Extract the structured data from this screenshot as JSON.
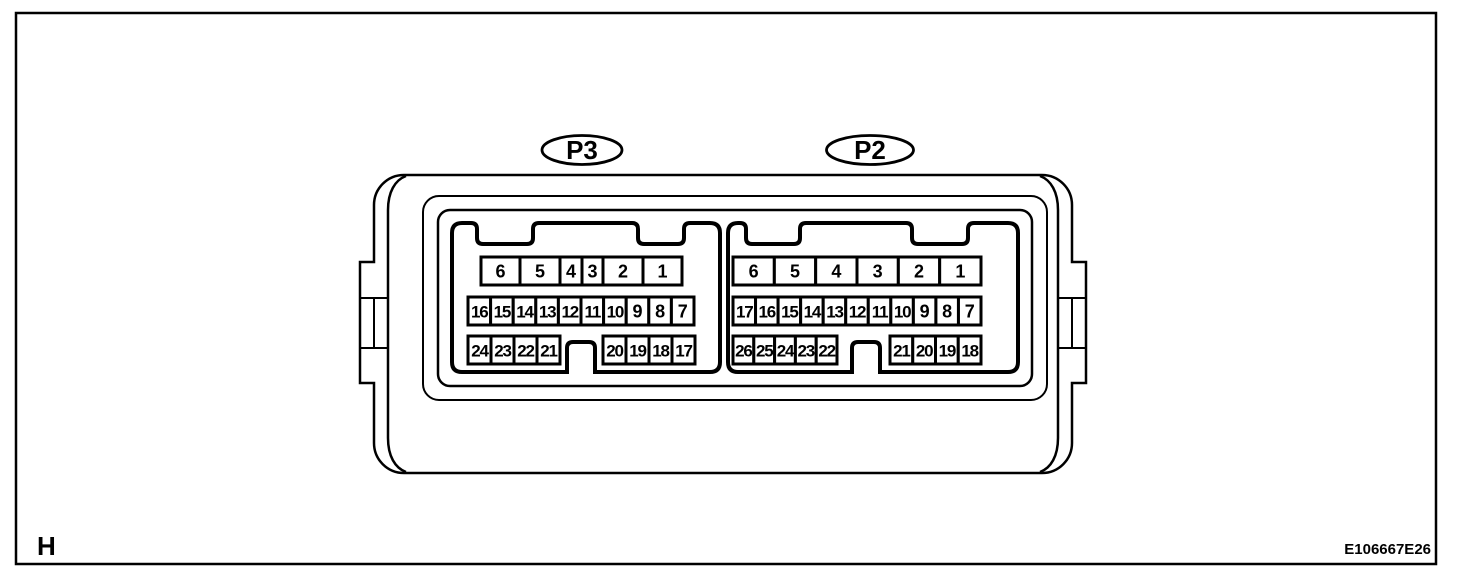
{
  "figure": {
    "page_marker": "H",
    "code": "E106667E26"
  },
  "colors": {
    "line": "#000000",
    "background": "#ffffff"
  },
  "connectors": [
    {
      "id": "P3",
      "label": "P3",
      "rows": [
        {
          "cells": [
            "6",
            "5",
            "4",
            "3",
            "2",
            "1"
          ]
        },
        {
          "cells": [
            "16",
            "15",
            "14",
            "13",
            "12",
            "11",
            "10",
            "9",
            "8",
            "7"
          ]
        },
        {
          "groups": [
            [
              "24",
              "23",
              "22",
              "21"
            ],
            [
              "20",
              "19",
              "18",
              "17"
            ]
          ]
        }
      ]
    },
    {
      "id": "P2",
      "label": "P2",
      "rows": [
        {
          "cells": [
            "6",
            "5",
            "4",
            "3",
            "2",
            "1"
          ]
        },
        {
          "cells": [
            "17",
            "16",
            "15",
            "14",
            "13",
            "12",
            "11",
            "10",
            "9",
            "8",
            "7"
          ]
        },
        {
          "groups": [
            [
              "26",
              "25",
              "24",
              "23",
              "22"
            ],
            [
              "21",
              "20",
              "19",
              "18"
            ]
          ]
        }
      ]
    }
  ]
}
